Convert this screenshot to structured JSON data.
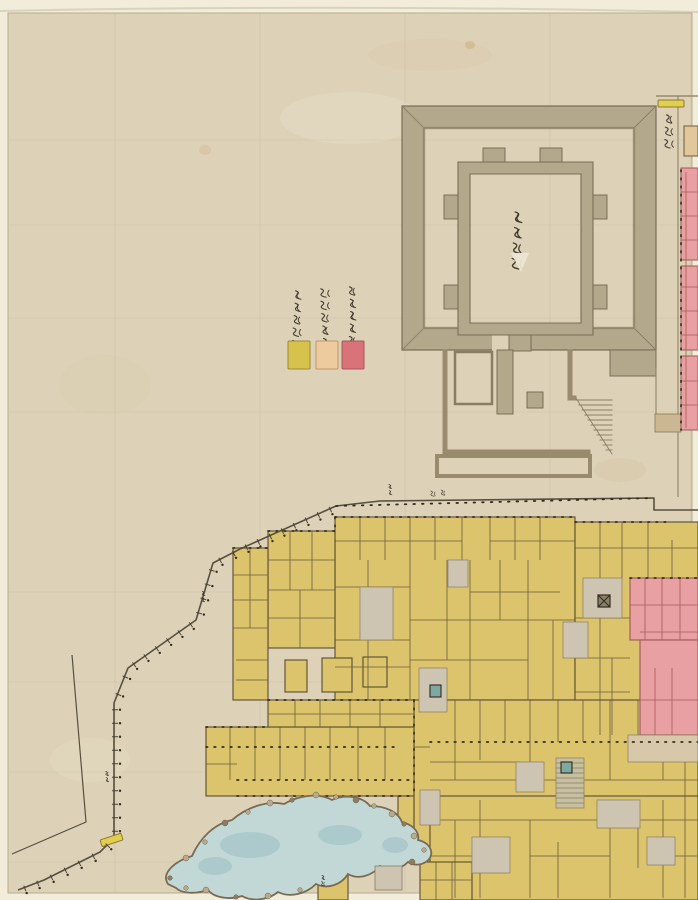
{
  "map": {
    "legend": {
      "items": [
        {
          "label": "御表向之分",
          "color": "#d7c34c"
        },
        {
          "label": "御広敷向分",
          "color": "#eecb9e"
        },
        {
          "label": "御長局向分",
          "color": "#d9737a"
        }
      ]
    },
    "keep": {
      "label": "御天守台"
    },
    "gates": {
      "top_right": "武具門"
    },
    "palette": {
      "backing": "#f2ecda",
      "paper": "#ddd2b8",
      "stone_wall": "#b3a78c",
      "wall_edge": "#7b6e57",
      "palace_yellow": "#dbc46c",
      "ooku_pink": "#e8a0a2",
      "pink_line": "#a65a58",
      "corridor_tan": "#cbb791",
      "building_tan": "#e2c79b",
      "pond_blue": "#c2d8d6",
      "pond_deep": "#a7c6c9",
      "ink": "#5a4c34",
      "dot_ink": "#352c1f",
      "gate_yellow": "#e3cf4f",
      "courtyard_gray": "#cdc5b1",
      "well_teal": "#7fa8a0"
    }
  }
}
